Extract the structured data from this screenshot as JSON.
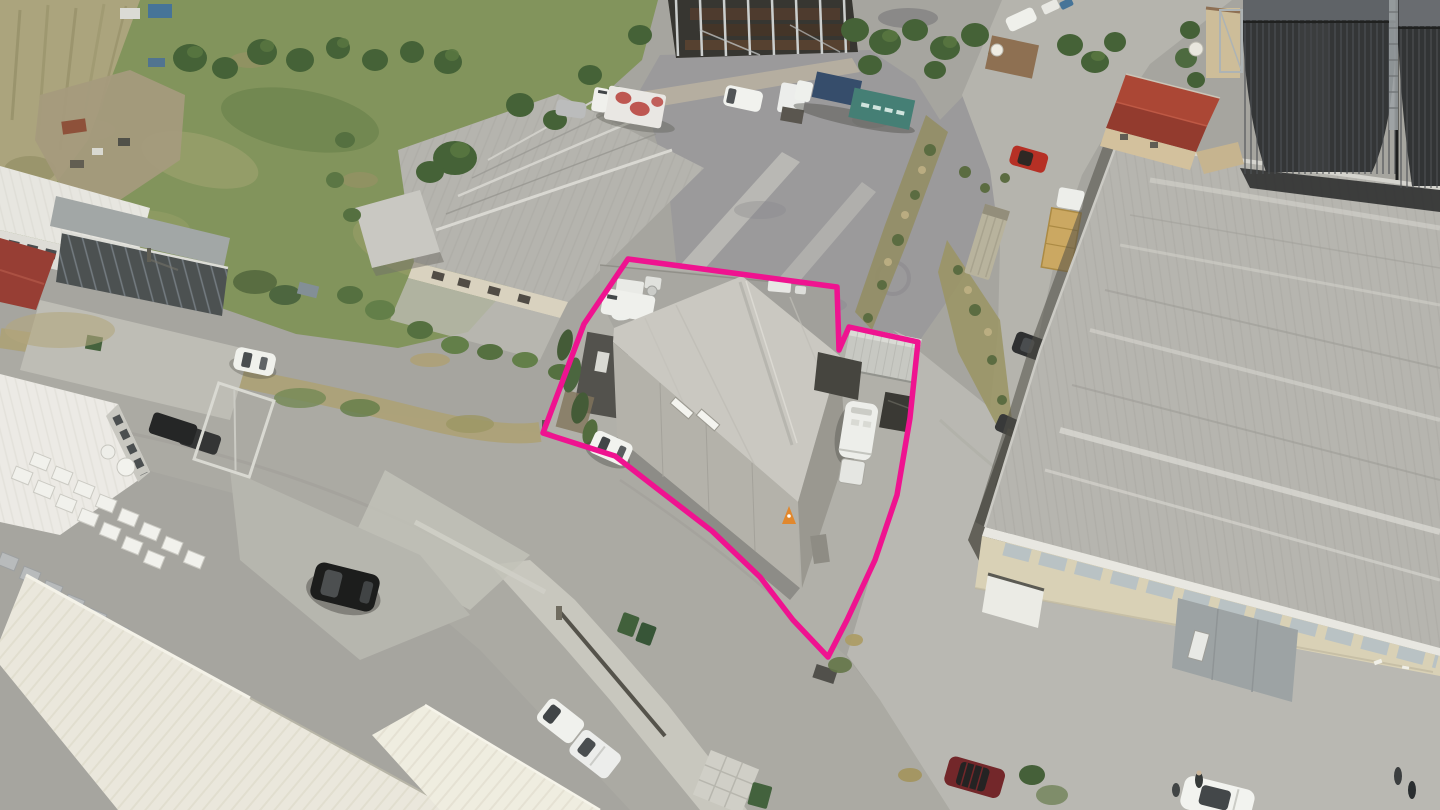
{
  "meta": {
    "kind": "aerial-drone-photograph",
    "subject": "industrial estate with a commercial warehouse property outlined for sale",
    "width": 1440,
    "height": 810
  },
  "annotation": {
    "boundary_points": "628,259 837,287 839,350 849,327 918,342 910,418 897,495 875,560 847,620 828,657 793,620 760,577 712,531 664,494 615,456 543,433 584,324",
    "color": "#ef1390",
    "stroke_width": "5.5"
  },
  "palette": {
    "asphalt": "#a3a29e",
    "gravel_lot": "#97969a",
    "road_light": "#b2b1ac",
    "concrete_apron": "#b7b6b1",
    "sidewalk": "#c6c5be",
    "field_green": "#7d9058",
    "tree_green": "#3e5c31",
    "dry_grass": "#aa9f72",
    "roof_white": "#e8e6e0",
    "roof_cream": "#eae7dd",
    "roof_gray": "#b3b2ae",
    "wall_cream": "#d8d0b6",
    "silo_dark": "#2c2e31",
    "red_roof": "#9e382d",
    "container_teal": "#3e7a72",
    "container_blue": "#2e4668",
    "car_red": "#b3281f",
    "car_dark_red": "#6e1f24",
    "vehicle_white": "#f0f1ee"
  },
  "scene": {
    "objects": [
      "grass-field",
      "reed-bed",
      "scrap-yard",
      "steel-frame-under-construction",
      "box-truck-red-livery",
      "white-van",
      "truck-with-blue-and-teal-containers",
      "gravel-yard",
      "tan-warehouse-with-gabled-roofs",
      "canopy",
      "outlined-property-warehouse",
      "roof-terrace-equipment",
      "white-caravan",
      "white-container",
      "parked-white-car",
      "traffic-cone",
      "large-gray-warehouse",
      "window-band",
      "gray-sliding-doors",
      "grain-silos",
      "red-roof-building",
      "container-trailer",
      "tan-box-truck",
      "red-car",
      "dark-suv",
      "white-warehouses",
      "stacked-white-crates",
      "black-suv",
      "sliding-gate",
      "green-wheelie-bins",
      "cream-corrugated-roofs",
      "white-pickups",
      "dark-red-car",
      "white-convertible-with-people",
      "roads",
      "sidewalk"
    ]
  }
}
